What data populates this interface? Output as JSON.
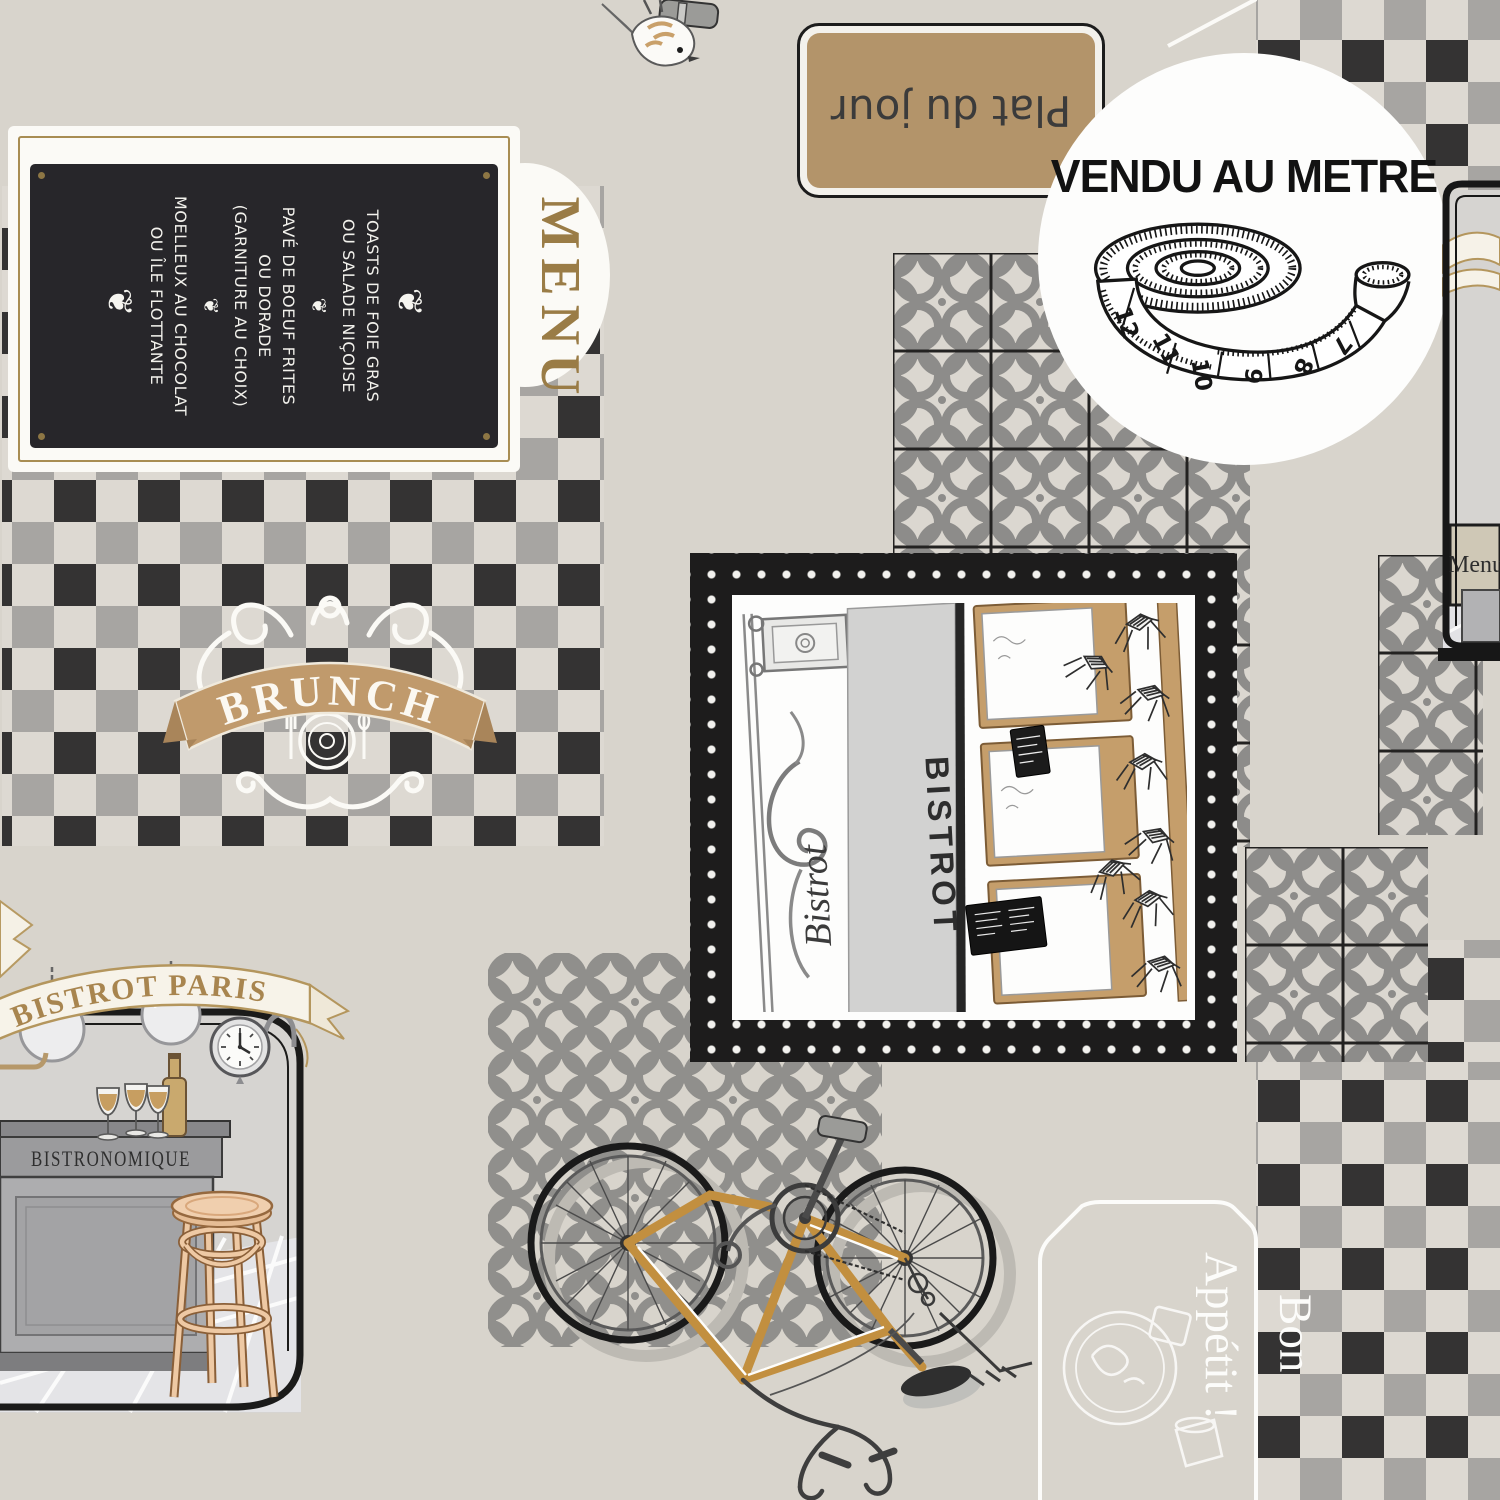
{
  "badge": {
    "label": "VENDU AU METRE",
    "tape_numbers": [
      "12",
      "11",
      "10",
      "9",
      "8",
      "7"
    ]
  },
  "menu_board": {
    "title": "MENU",
    "ornament": "❦",
    "divider": "❦",
    "courses": [
      {
        "lines": [
          "TOASTS DE FOIE GRAS",
          "OU SALADE NIÇOISE"
        ]
      },
      {
        "lines": [
          "PAVÉ DE BOEUF FRITES",
          "OU DORADE",
          "(GARNITURE AU CHOIX)"
        ]
      },
      {
        "lines": [
          "MOELLEUX AU CHOCOLAT",
          "OU ÎLE FLOTTANTE"
        ]
      }
    ]
  },
  "plat_sign": {
    "label": "Plat du jour"
  },
  "brunch_emblem": {
    "label": "BRUNCH"
  },
  "bistrot_frame": {
    "sign": "BISTROT",
    "script": "Bistrot"
  },
  "bistro_scene": {
    "banner": "BISTROT PARIS",
    "counter_label": "BISTRONOMIQUE"
  },
  "right_scene": {
    "menu_sign": "Menu"
  },
  "bon_appetit": {
    "word1": "Bon",
    "word2": "Appétit !"
  },
  "colors": {
    "background": "#d8d4cc",
    "tan": "#bb9c72",
    "check_black": "#343333",
    "check_gray": "#a7a5a2",
    "tile_gray": "#8d8c8a",
    "cream": "#f6f2e8"
  }
}
